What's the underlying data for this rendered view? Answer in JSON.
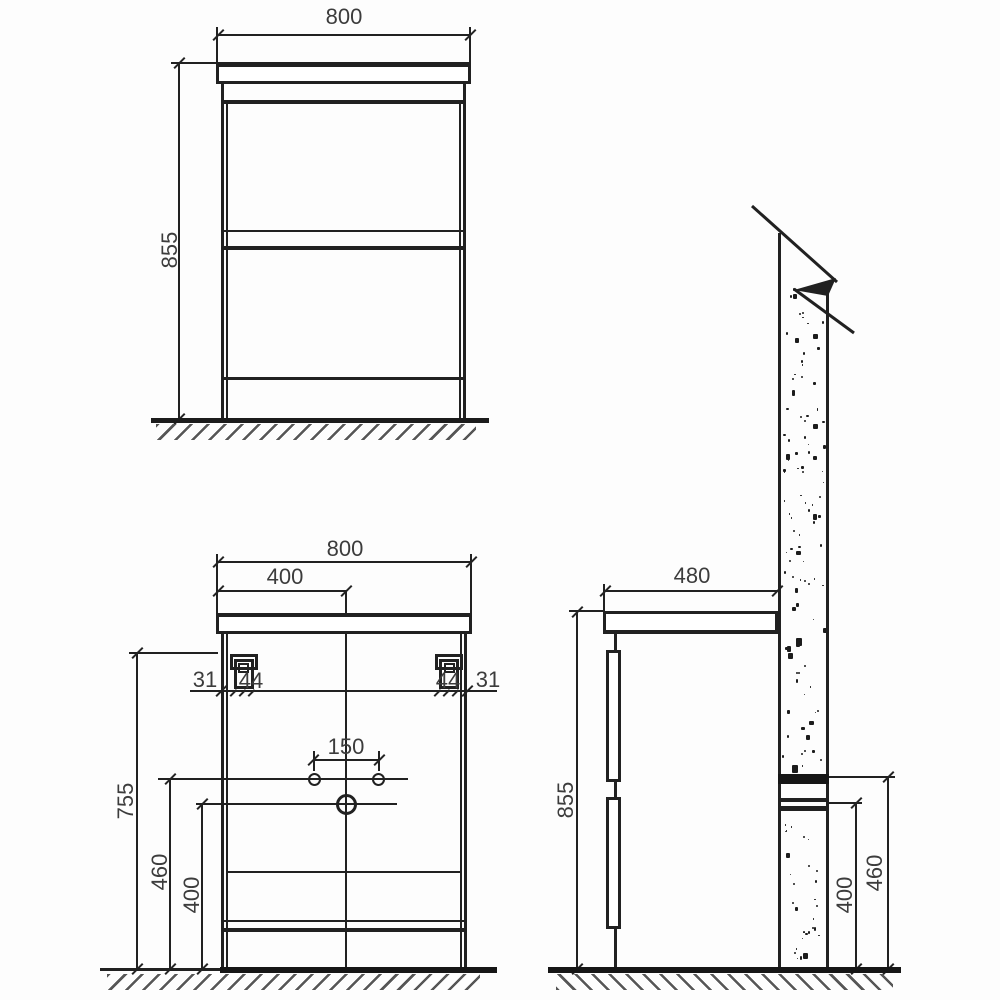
{
  "drawing": {
    "ink_color": "#212121",
    "front_view": {
      "width": "800",
      "height": "855"
    },
    "back_view": {
      "width": "800",
      "center_offset": "400",
      "left_edge_offset": "31",
      "left_bracket_width": "44",
      "right_bracket_width": "44",
      "right_edge_offset": "31",
      "faucet_hole_spacing": "150",
      "bracket_height": "755",
      "supply_height": "460",
      "drain_height": "400"
    },
    "side_view": {
      "depth": "480",
      "height": "855",
      "drain_height": "400",
      "supply_height": "460"
    }
  }
}
